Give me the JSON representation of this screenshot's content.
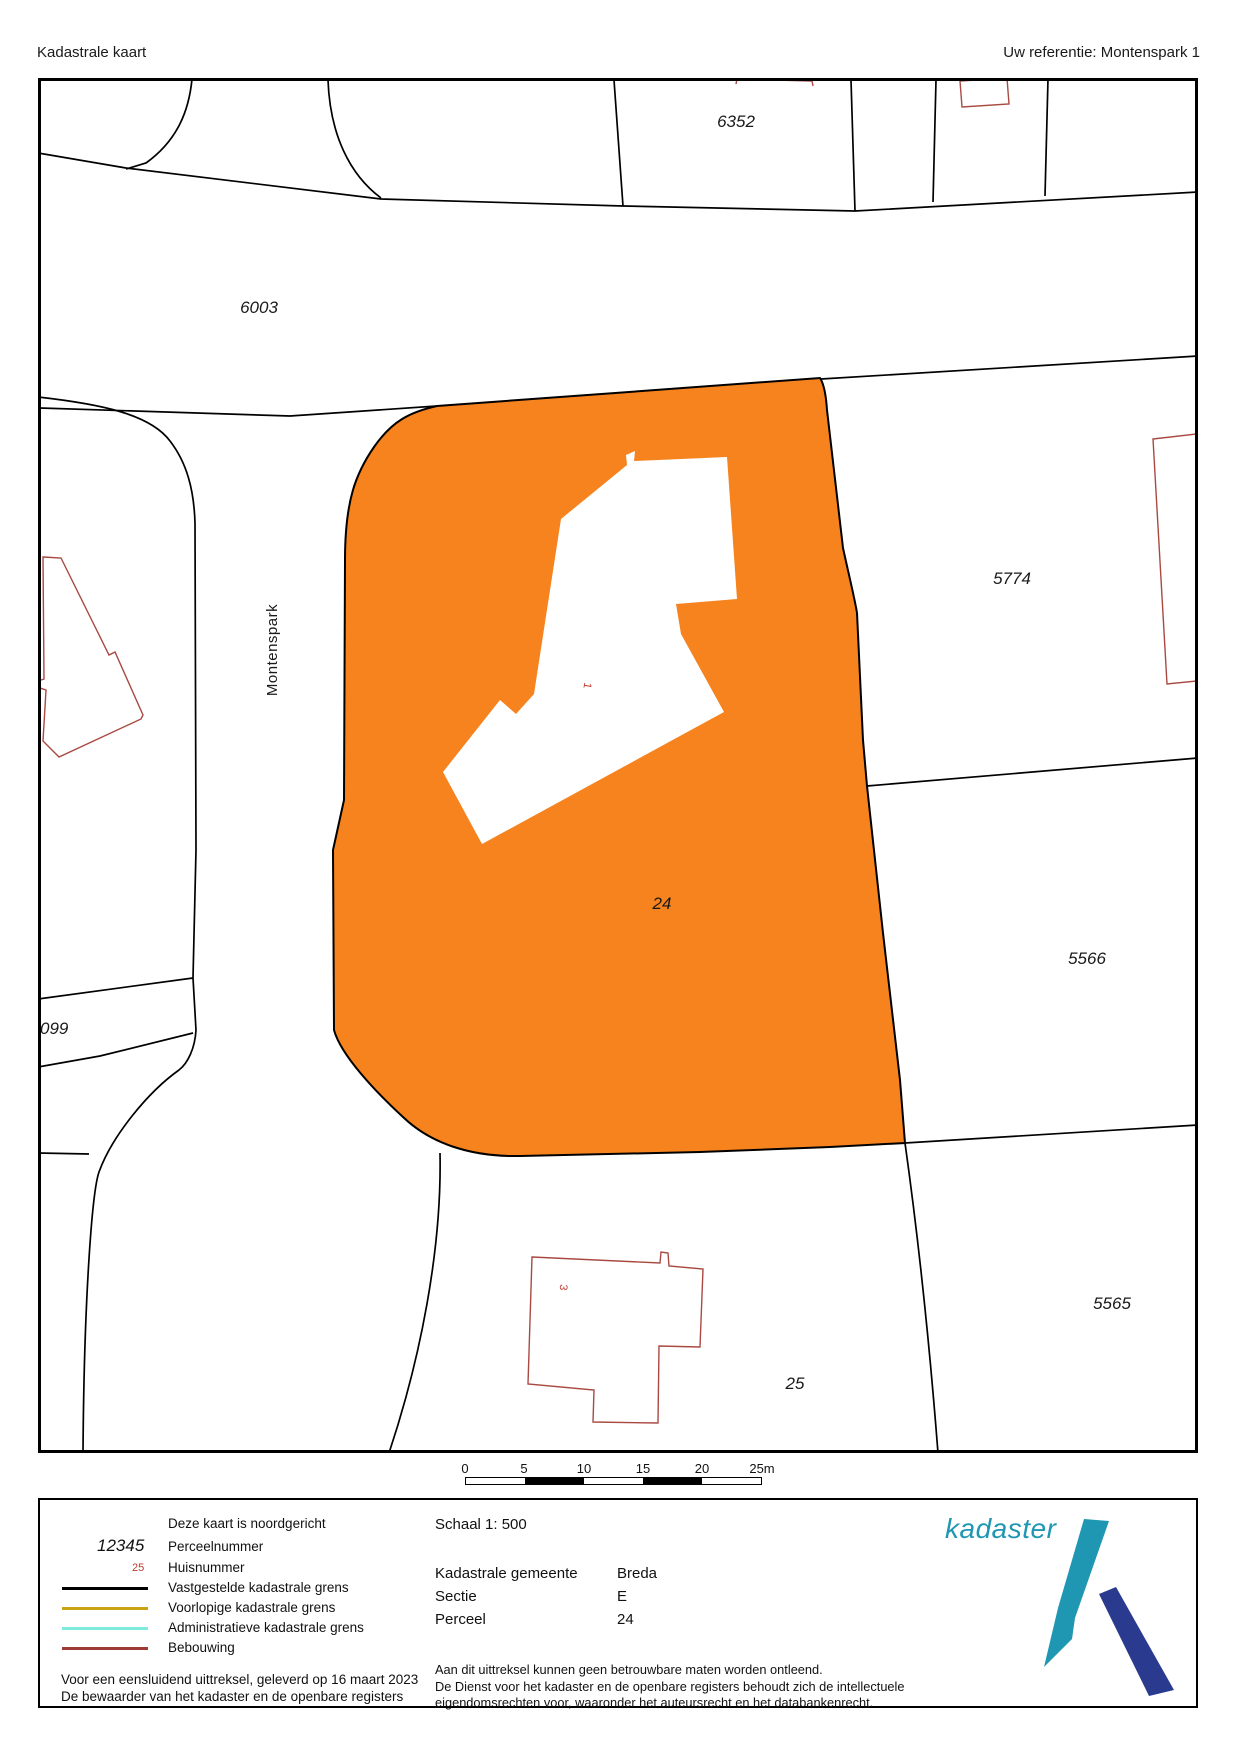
{
  "header": {
    "title": "Kadastrale kaart",
    "reference": "Uw referentie: Montenspark 1"
  },
  "map": {
    "highlight_color": "#F6831E",
    "boundary_color": "#000000",
    "building_outline_color": "#A94A42",
    "house_number_color": "#C03B2F",
    "street_label": "Montenspark",
    "parcel_labels": [
      {
        "id": "6352"
      },
      {
        "id": "6003"
      },
      {
        "id": "5774"
      },
      {
        "id": "5566"
      },
      {
        "id": "5565"
      },
      {
        "id": "24"
      },
      {
        "id": "25"
      },
      {
        "id": "099"
      }
    ],
    "house_numbers": [
      {
        "id": "1"
      },
      {
        "id": "3"
      }
    ]
  },
  "scalebar": {
    "labels": [
      "0",
      "5",
      "10",
      "15",
      "20",
      "25m"
    ]
  },
  "legend": {
    "north_note": "Deze kaart is noordgericht",
    "parcel_number_sample": "12345",
    "parcel_number_label": "Perceelnummer",
    "house_number_sample": "25",
    "house_number_label": "Huisnummer",
    "lines": [
      {
        "label": "Vastgestelde kadastrale grens",
        "color": "#000000"
      },
      {
        "label": "Voorlopige kadastrale grens",
        "color": "#C8A414"
      },
      {
        "label": "Administratieve kadastrale grens",
        "color": "#7DEBDD"
      },
      {
        "label": "Bebouwing",
        "color": "#9E3B36"
      }
    ],
    "footer_line1": "Voor een eensluidend uittreksel, geleverd op 16 maart 2023",
    "footer_line2": "De bewaarder van het kadaster en de openbare registers",
    "schaal": "Schaal 1: 500",
    "details": [
      {
        "label": "Kadastrale gemeente",
        "value": "Breda"
      },
      {
        "label": "Sectie",
        "value": "E"
      },
      {
        "label": "Perceel",
        "value": "24"
      }
    ],
    "disclaimer1": "Aan dit uittreksel kunnen geen betrouwbare maten worden ontleend.",
    "disclaimer2": "De Dienst voor het kadaster en de openbare registers behoudt zich de intellectuele",
    "disclaimer3": "eigendomsrechten voor, waaronder het auteursrecht en het databankenrecht.",
    "logo_text": "kadaster",
    "logo_teal": "#1F97B2",
    "logo_navy": "#2A3B8F"
  }
}
